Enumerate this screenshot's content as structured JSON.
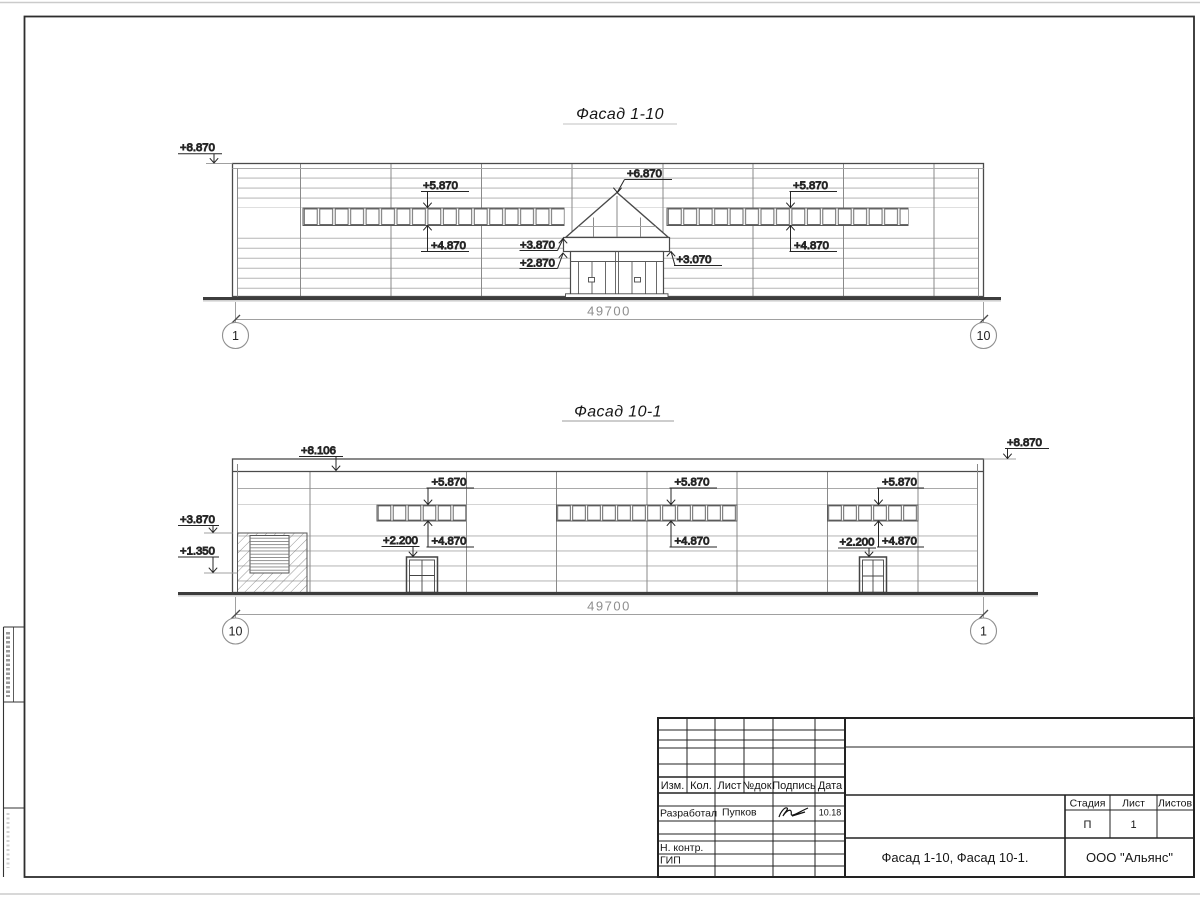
{
  "drawing": {
    "facade1": {
      "title": "Фасад 1-10",
      "dim": "49700",
      "axis_left": "1",
      "axis_right": "10",
      "marks": {
        "top_left": "+8.870",
        "band_left_top": "+5.870",
        "band_left_bottom": "+4.870",
        "apex": "+6.870",
        "canopy_top": "+3.870",
        "entrance_top": "+2.870",
        "canopy_right": "+3.070",
        "band_right_top": "+5.870",
        "band_right_bottom": "+4.870"
      }
    },
    "facade2": {
      "title": "Фасад 10-1",
      "dim": "49700",
      "axis_left": "10",
      "axis_right": "1",
      "marks": {
        "roof": "+8.106",
        "top_right": "+8.870",
        "left_upper": "+3.870",
        "left_lower": "+1.350",
        "band1_top": "+5.870",
        "band1_bottom": "+4.870",
        "band2_top": "+5.870",
        "band2_bottom": "+4.870",
        "band3_top": "+5.870",
        "band3_bottom": "+4.870",
        "door1": "+2.200",
        "door2": "+2.200"
      }
    }
  },
  "title_block": {
    "columns": {
      "izm": "Изм.",
      "kol": "Кол.",
      "list": "Лист",
      "ndok": "№док.",
      "podpis": "Подпись",
      "data": "Дата"
    },
    "developed_by_label": "Разработал",
    "developed_by_name": "Пупков",
    "developed_date": "10.18",
    "n_kontr_label": "Н. контр.",
    "gip_label": "ГИП",
    "stage_label": "Стадия",
    "sheet_label": "Лист",
    "sheets_label": "Листов",
    "stage_value": "П",
    "sheet_value": "1",
    "sheets_value": "",
    "doc_title": "Фасад 1-10, Фасад 10-1.",
    "company": "ООО \"Альянс\""
  }
}
